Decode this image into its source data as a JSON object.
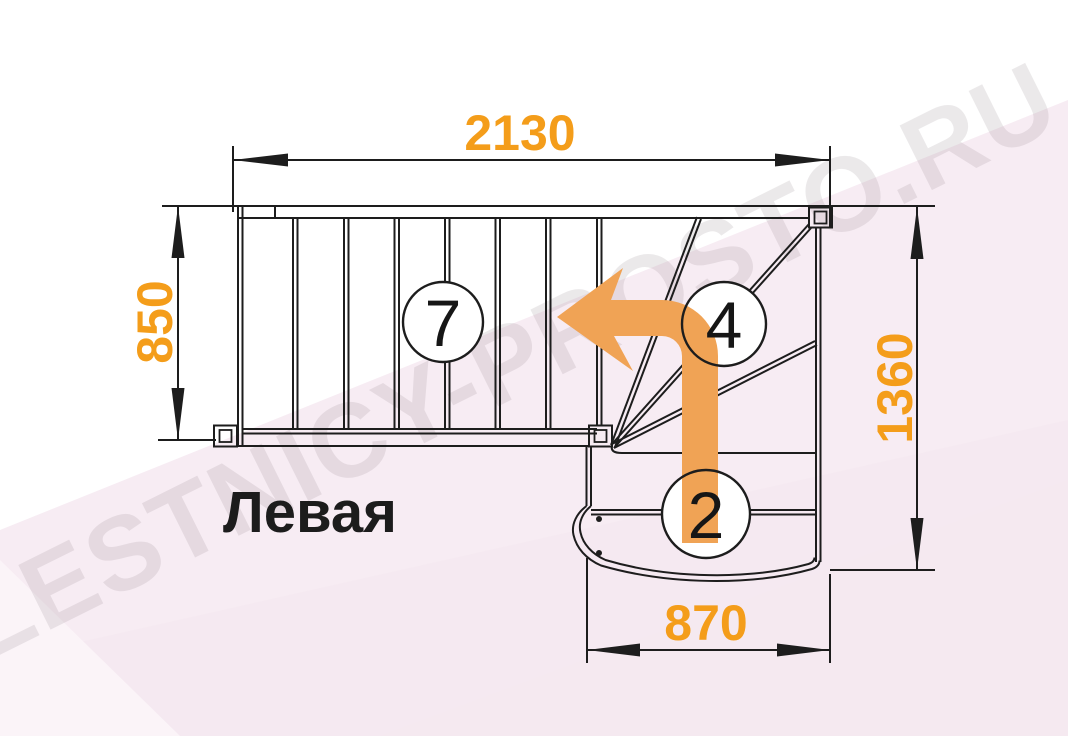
{
  "diagram": {
    "type": "staircase-floor-plan",
    "title": "Левая",
    "watermark": "LESTNICY-PROSTO.RU",
    "dimensions": {
      "top_width": "2130",
      "left_depth": "850",
      "right_height": "1360",
      "bottom_width": "870"
    },
    "step_labels": {
      "straight_flight": "7",
      "winder_steps": "4",
      "bottom_steps": "2"
    },
    "colors": {
      "dimension_text": "#F49D1A",
      "arrow": "#F0A355",
      "line": "#1D1D1D",
      "background_tint": "#F7ECF3",
      "watermark": "#8A7D85"
    }
  }
}
